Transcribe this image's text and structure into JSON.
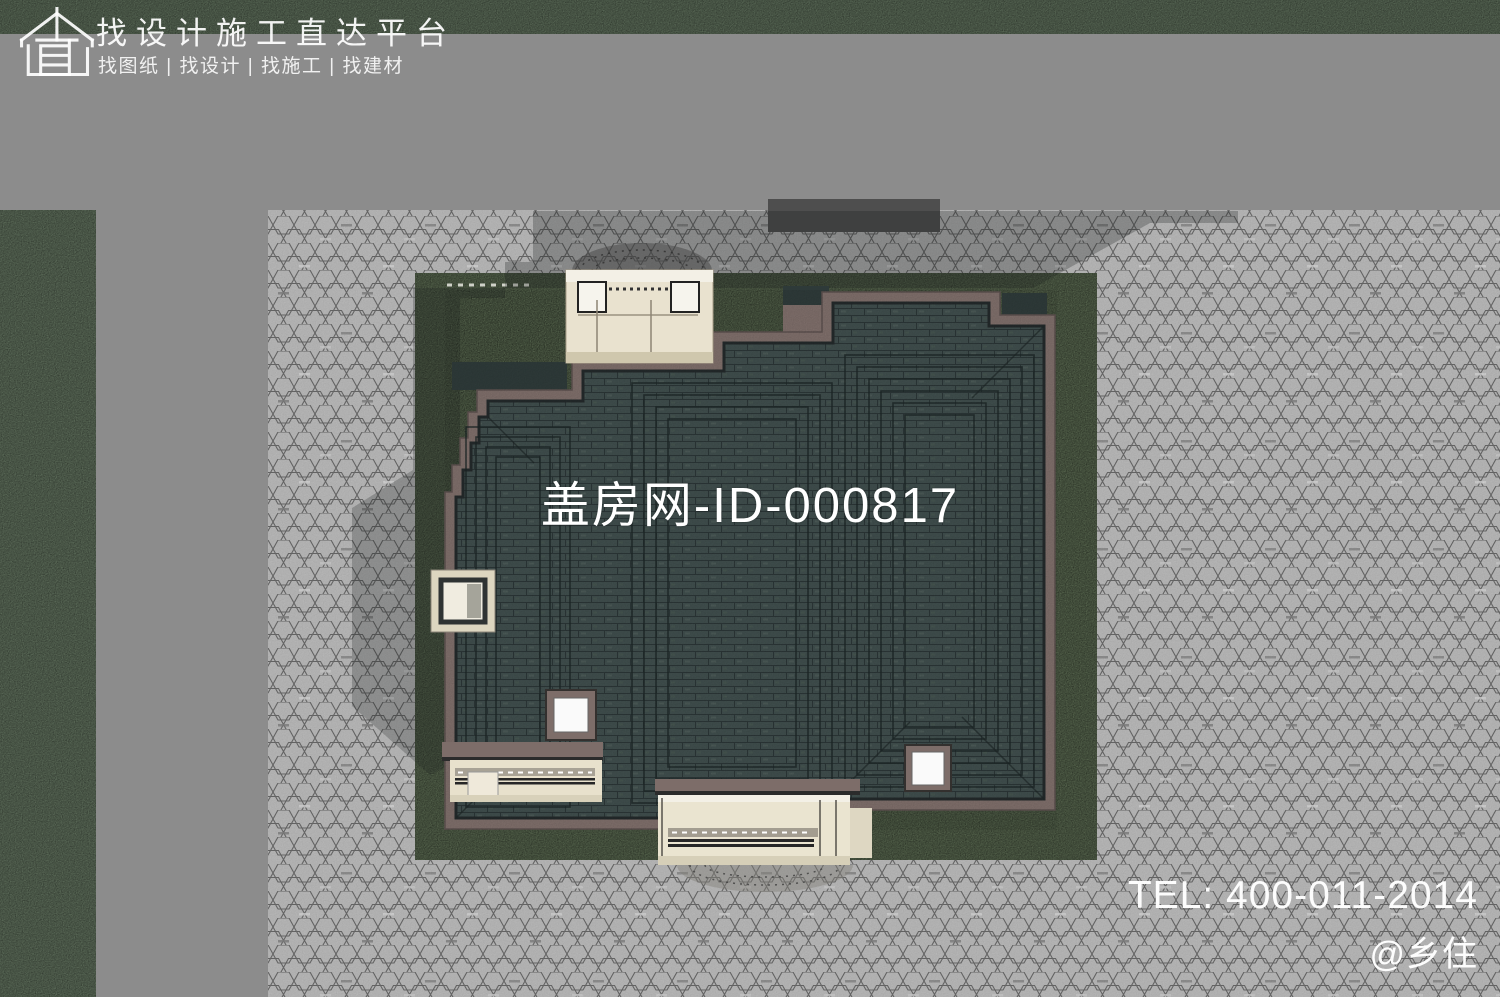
{
  "branding": {
    "logo_icon": "house-blueprint-icon",
    "title": "找设计施工直达平台",
    "services": "找图纸 | 找设计 | 找施工 | 找建材"
  },
  "watermark": {
    "center_id": "盖房网-ID-000817",
    "tel": "TEL: 400-011-2014",
    "handle": "@乡住"
  },
  "scene": {
    "description": "Aerial top-down rendering of a villa site plan: dark tiled hip roof with brown fascia, beige entry porches, green lawn, hexagonal paver plaza, grass verge and gray road.",
    "colors": {
      "road_gray": "#8a8a8a",
      "grass_green": "#5a6a57",
      "lawn_green": "#57664e",
      "paver_gray": "#b7b7b7",
      "roof_tile": "#3f4d4c",
      "roof_fascia": "#7d6d69",
      "porch_beige": "#e9e2cf",
      "skylight_white": "#fafafa",
      "watermark_text": "#ffffff"
    }
  }
}
